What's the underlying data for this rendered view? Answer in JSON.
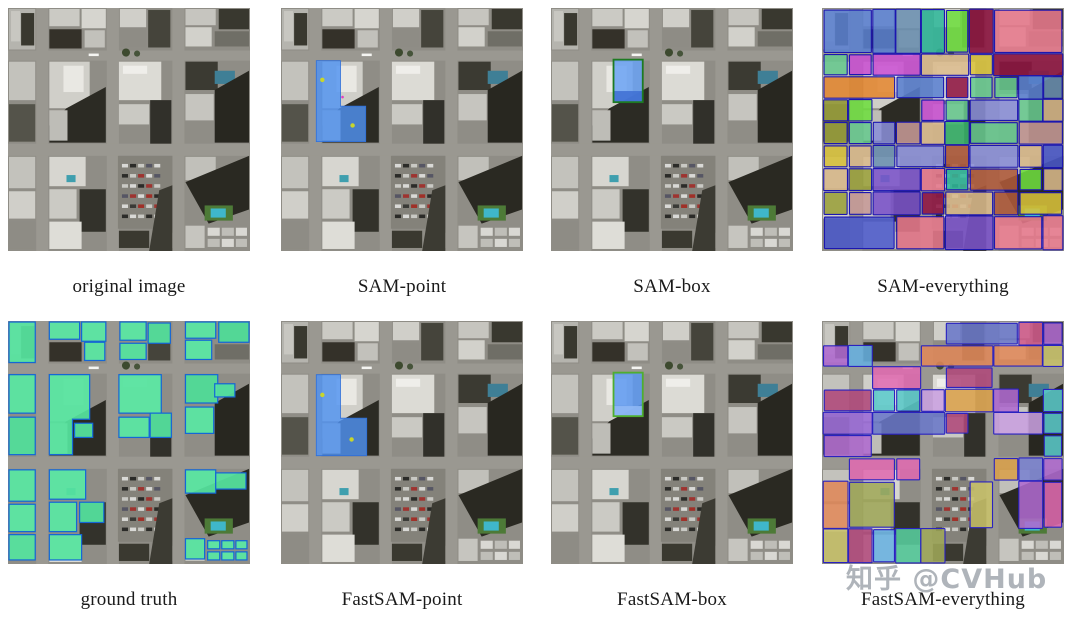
{
  "figure": {
    "type": "segmentation-comparison-figure",
    "panels": [
      {
        "id": "original-image",
        "caption": "original image",
        "overlay": "none"
      },
      {
        "id": "sam-point",
        "caption": "SAM-point",
        "overlay": "point-sam"
      },
      {
        "id": "sam-box",
        "caption": "SAM-box",
        "overlay": "box-sam"
      },
      {
        "id": "sam-everything",
        "caption": "SAM-everything",
        "overlay": "everything-sam"
      },
      {
        "id": "ground-truth",
        "caption": "ground truth",
        "overlay": "ground-truth"
      },
      {
        "id": "fastsam-point",
        "caption": "FastSAM-point",
        "overlay": "point-fast"
      },
      {
        "id": "fastsam-box",
        "caption": "FastSAM-box",
        "overlay": "box-fast"
      },
      {
        "id": "fastsam-everything",
        "caption": "FastSAM-everything",
        "overlay": "everything-fast"
      }
    ],
    "watermark": {
      "text": "知乎 @CVHub",
      "color": "#afb4ba"
    },
    "colors": {
      "prompt_mask_blue": "#4f93f2",
      "prompt_point_yellow": "#c8d62b",
      "box_prompt_green": "#1d7a22",
      "ground_truth_green": "#55e39e",
      "mask_outline_blue": "#1467d6"
    },
    "palettes": {
      "sam_everything": [
        "#c94fd1",
        "#e8798c",
        "#8f1340",
        "#37b36a",
        "#6ede3e",
        "#2fb89a",
        "#e2852e",
        "#d9b98a",
        "#c79a96",
        "#5a7fd0",
        "#7a52c9",
        "#9aa03a",
        "#d9c23a",
        "#6a8fb0",
        "#8a8fd8",
        "#4a57c9",
        "#b05a3a",
        "#67c98f"
      ],
      "fastsam_everything": [
        "#8a8fd8",
        "#b06ad0",
        "#e06ab0",
        "#c9c26a",
        "#d9a04a",
        "#66b0e0",
        "#58d0a0",
        "#9a6ad8",
        "#d05a8a",
        "#a0a858",
        "#6a78c9",
        "#e08858",
        "#7a82d0",
        "#c9a0e0",
        "#5ac9c9",
        "#b0477a"
      ]
    },
    "mosaic": {
      "sam": {
        "seed": 7,
        "gap": 0.05,
        "stroke": "#1c16b0"
      },
      "fast": {
        "seed": 13,
        "gap": 0.2,
        "stroke": "#2a22c0",
        "holes": [
          [
            98,
            146,
            172,
            240
          ]
        ]
      }
    }
  }
}
